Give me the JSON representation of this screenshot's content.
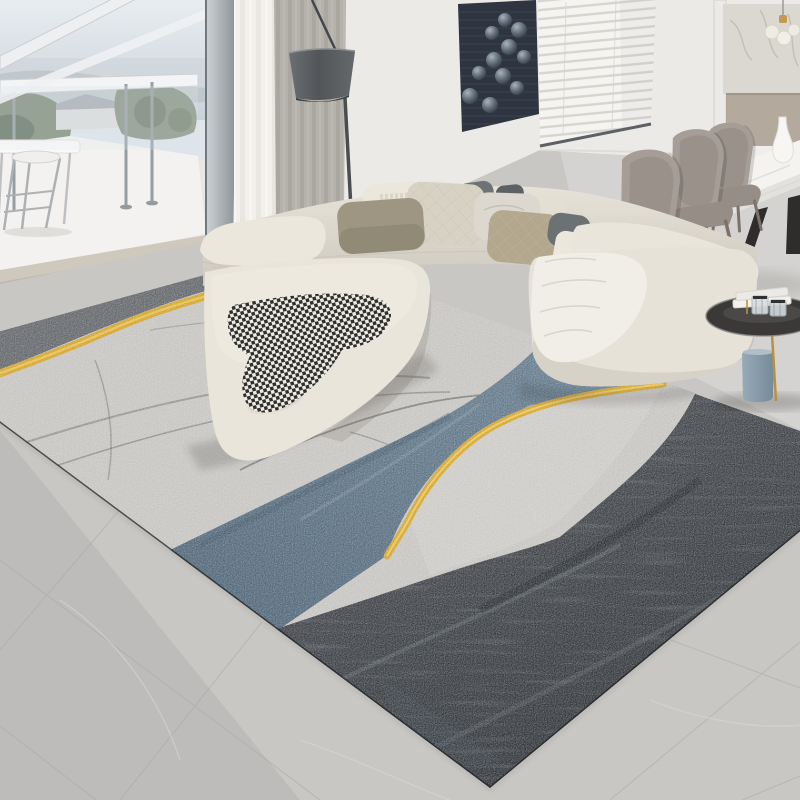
{
  "meta": {
    "type": "photograph",
    "subject": "Modern living room with abstract gray, steel-blue and gold area rug, cream sectional sofa, balcony window, venetian blinds and dining set"
  },
  "palette": {
    "wall": "#e9e6e1",
    "floor": "#c9c7c4",
    "window_frame": "#a9b0b5",
    "sky": "#dde4e8",
    "greenery": "#71806a",
    "balcony_floor": "#f4f3f0",
    "threshold": "#c0b8ab",
    "curtain_sheer": "#f2f0ea",
    "curtain_gray": "#b5b1ab",
    "lamp_shade": "#5d6164",
    "art_panel": "#2e3540",
    "blinds": "#f5f4f1",
    "marble": "#dbd8d2",
    "cabinet": "#b3aa9d",
    "sofa": "#e7e2d7",
    "ottoman": "#eae5da",
    "throw_white": "#f1eee8",
    "chair": "#a69e96",
    "table_top": "#f4f3f0",
    "table_leg": "#2e2d2b",
    "side_table": "#3a3938",
    "vase_blue": "#8ba0ae",
    "gold": "#c9a355",
    "rug_base": "#c7c5c2",
    "rug_dark_band": "#64686c",
    "rug_gold": "#d4a42e",
    "rug_blue": "#5a7183",
    "rug_charcoal": "#3a3f44",
    "pillow_olive": "#9e9682",
    "pillow_quilt": "#d8d2c5",
    "pillow_crinkle": "#dcd8cf",
    "pillow_dark": "#6f7274",
    "pillow_slate": "#5c6164",
    "pillow_tan": "#b3a88e",
    "pillow_white": "#ece7db"
  },
  "objects": {
    "labels": [
      "floor-to-ceiling window with balcony and bar stool",
      "glass balcony railing with sky and greenery view",
      "sheer curtain and gray curtain",
      "arc floor lamp with dark cone shade",
      "dark wall art panel with glossy spheres",
      "window with white venetian blinds",
      "kitchen niche with marble backsplash and glass pendant",
      "white marble dining table with black trestle legs",
      "three taupe leather dining chairs",
      "white ceramic vase on dining table",
      "cream L-shaped sectional sofa with assorted pillows",
      "houndstooth throw on cream ottoman",
      "white knit throw on chaise",
      "round black glass side table with crystal decor",
      "blue-gray cylinder floor vase",
      "abstract area rug: gray field, charcoal band, steel blue sweep, gold stripes",
      "gray marble tile floor"
    ]
  }
}
